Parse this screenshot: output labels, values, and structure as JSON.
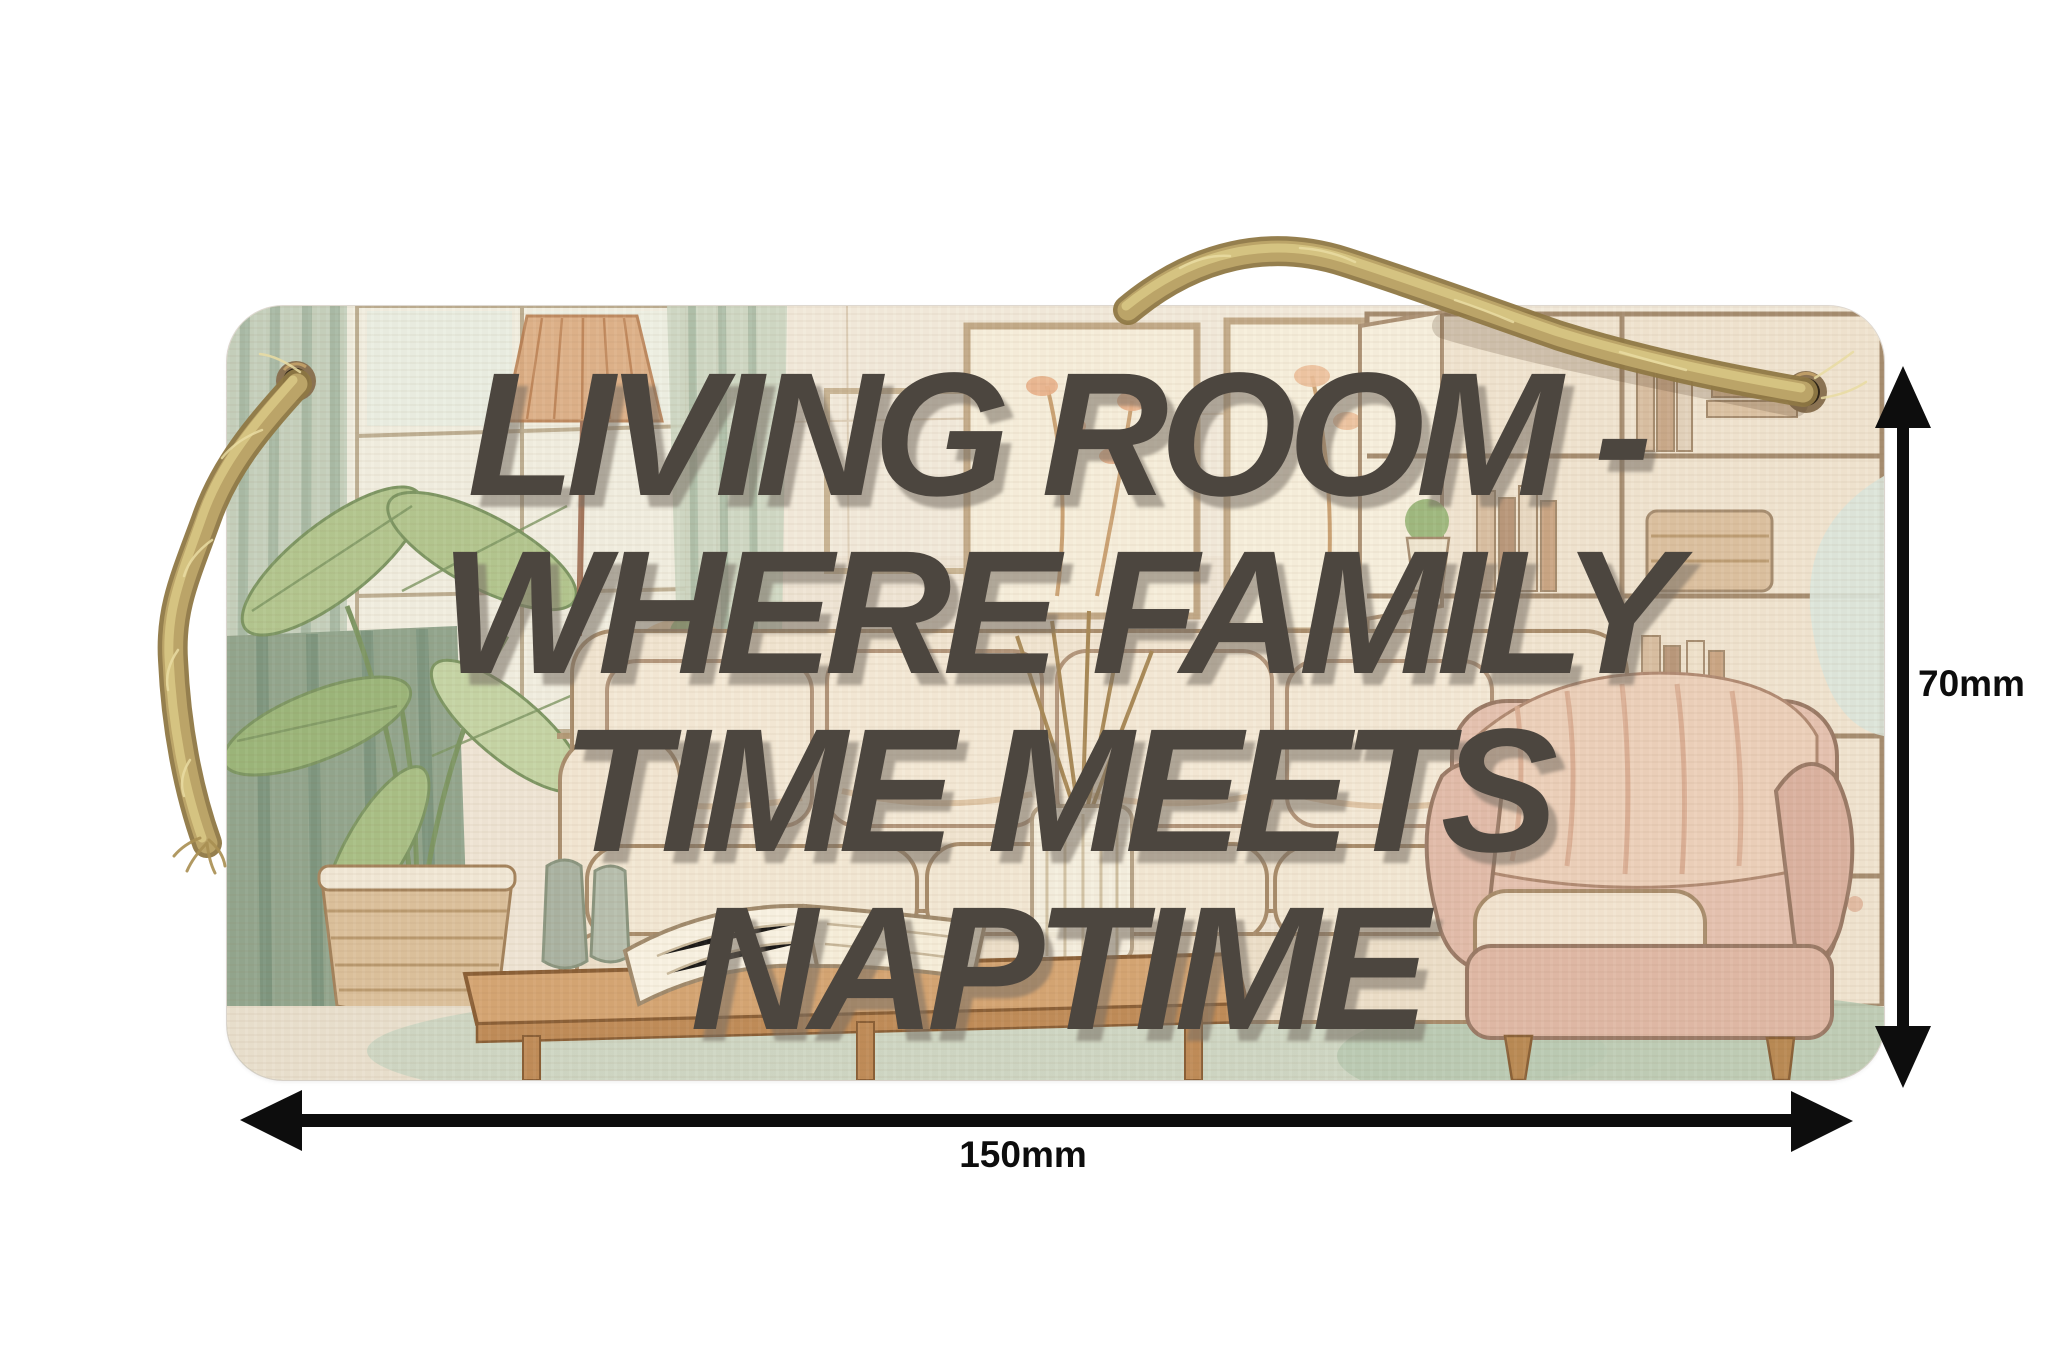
{
  "sign": {
    "lines": [
      "LIVING ROOM -",
      "WHERE FAMILY",
      "TIME MEETS",
      "NAPTIME"
    ],
    "text_color": "#4c463f"
  },
  "dimensions": {
    "width_label": "150mm",
    "height_label": "70mm",
    "arrow_color": "#0d0d0d"
  },
  "materials": {
    "rope_color": "#b7a061",
    "wood_base_color": "#efe5d5"
  }
}
